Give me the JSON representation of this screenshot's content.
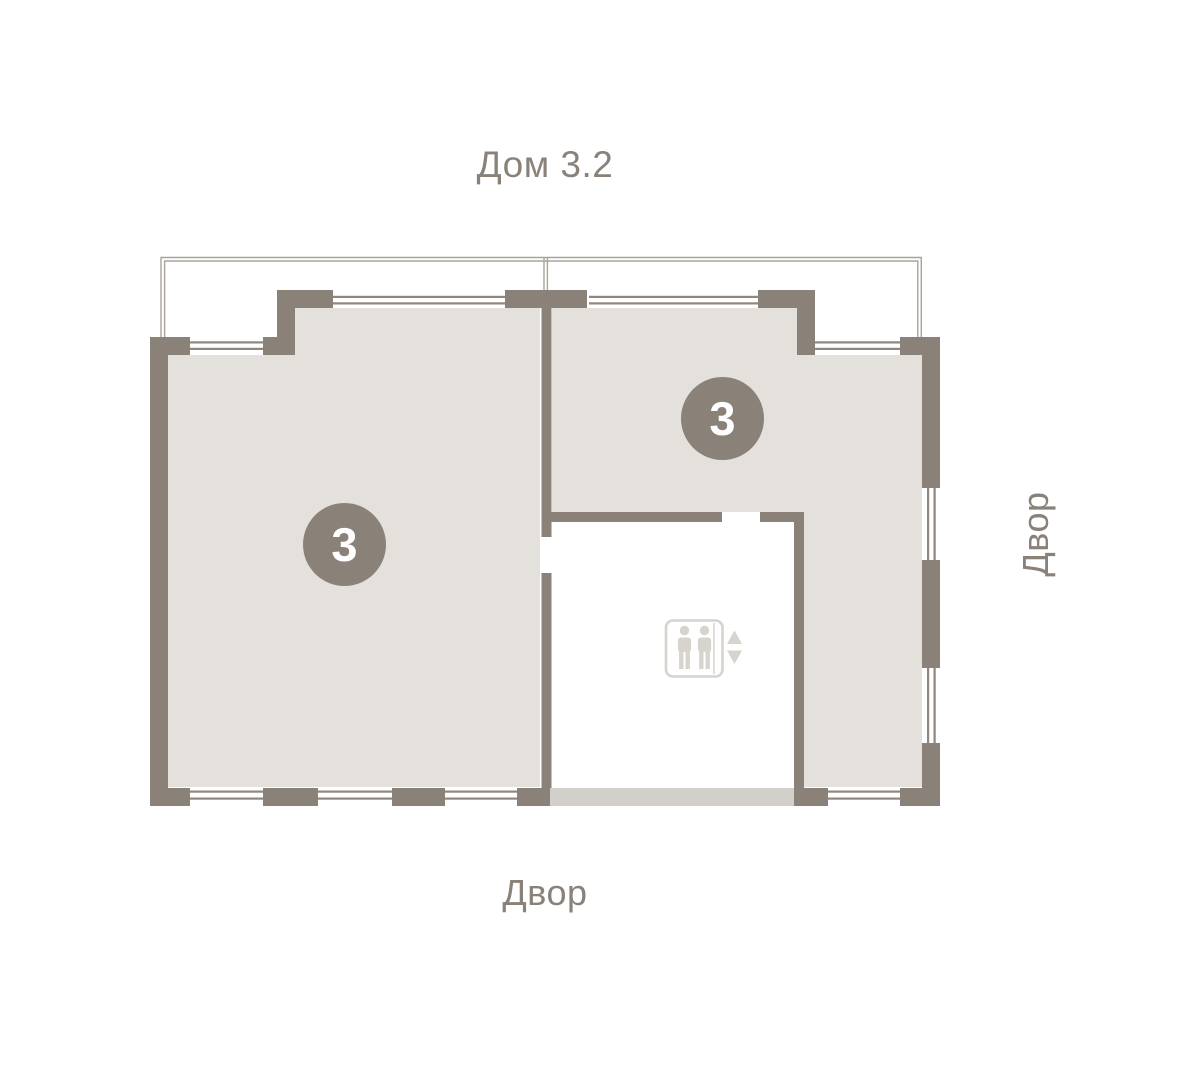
{
  "title": "Дом 3.2",
  "labels": {
    "courtyard_right": "Двор",
    "courtyard_bottom": "Двор"
  },
  "units": {
    "left": {
      "rooms": "3"
    },
    "right": {
      "rooms": "3"
    }
  },
  "icons": {
    "elevator": "elevator-icon"
  },
  "colors": {
    "wall": "#8a8178",
    "apartment_fill": "#e4e1dd",
    "corridor_floor": "#d3d0ca",
    "balcony_line": "#a9a39b",
    "window_line": "#8f867d",
    "badge_bg": "#8a8178",
    "badge_text": "#ffffff",
    "label_text": "#8a8279",
    "elevator_icon": "#d7d3cd",
    "background": "#ffffff"
  }
}
